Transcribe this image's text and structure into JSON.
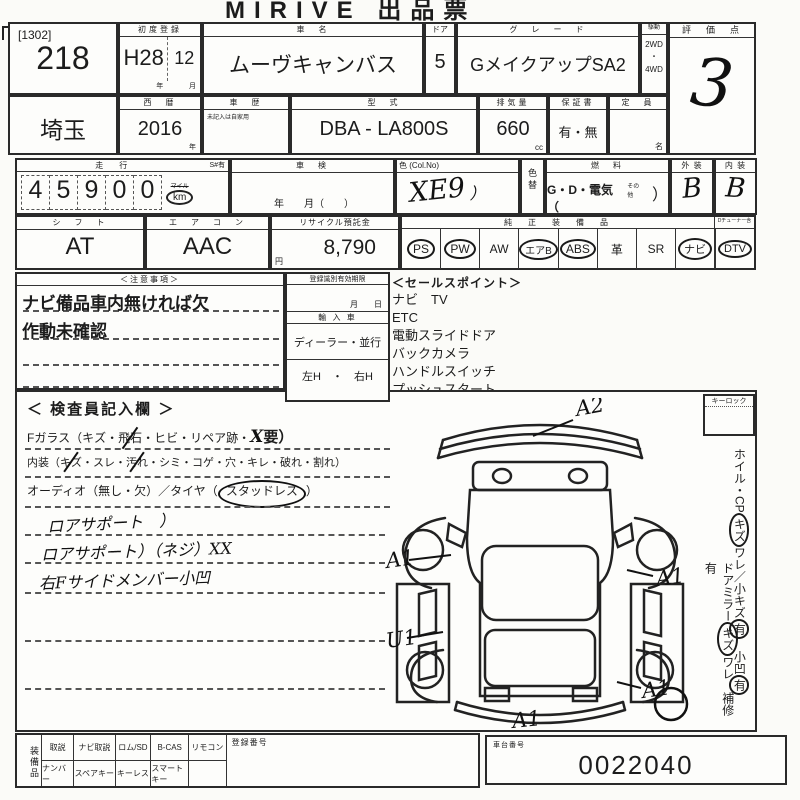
{
  "colors": {
    "ink": "#1c1c1c",
    "paper": "#fbfbf8"
  },
  "title": "MIRIVE 出品票",
  "lot": {
    "code": "[1302]",
    "number": "218"
  },
  "first_reg": {
    "label": "初度登録",
    "era": "H28",
    "month": "12",
    "year_unit": "年",
    "month_unit": "月"
  },
  "car": {
    "name_label": "車　名",
    "name": "ムーヴキャンバス",
    "door_label": "ドア",
    "door": "5",
    "grade_label": "グ　レ　ー　ド",
    "grade": "GメイクアップSA2",
    "drive_label": "駆動",
    "drive_2wd": "2WD",
    "drive_sep": "・",
    "drive_4wd": "4WD"
  },
  "score": {
    "label": "評　価　点",
    "value": "3"
  },
  "reg2": {
    "prefecture": "埼玉",
    "year_label": "西　暦",
    "year": "2016",
    "year_unit": "年",
    "history_label": "車　歴",
    "history_note": "未記入は自家用",
    "model_label": "型　式",
    "model": "DBA - LA800S",
    "disp_label": "排気量",
    "disp": "660",
    "disp_unit": "cc",
    "warranty_label": "保証書",
    "warranty": "有・無",
    "capacity_label": "定　員",
    "capacity_unit": "名"
  },
  "mileage": {
    "label": "走　行",
    "s_label": "S#有",
    "digits": [
      "4",
      "5",
      "9",
      "0",
      "0"
    ],
    "mile": "マイル",
    "km": "km"
  },
  "shaken": {
    "label": "車　検",
    "units": "年　　月（　　）"
  },
  "color": {
    "label": "色 (Col.No)",
    "value": "XE9",
    "paren": "）",
    "change_label": "色替"
  },
  "fuel": {
    "label": "燃　料",
    "value": "G・D・電気（",
    "other": "その他",
    "close": "）"
  },
  "panels": {
    "ext_label": "外 装",
    "ext": "B",
    "int_label": "内 装",
    "int": "B"
  },
  "row4": {
    "shift_label": "シ　フ　ト",
    "shift": "AT",
    "aircon_label": "エ　ア　コ　ン",
    "aircon": "AAC",
    "recycle_label": "リサイクル預託金",
    "recycle": "8,790",
    "recycle_unit": "円",
    "equip_label": "純　正　装　備　品",
    "dtv_note": "Dチューナー含",
    "equip_items": [
      {
        "text": "PS",
        "circled": true
      },
      {
        "text": "PW",
        "circled": true
      },
      {
        "text": "AW",
        "circled": false
      },
      {
        "text": "エアB",
        "circled": true
      },
      {
        "text": "ABS",
        "circled": true
      },
      {
        "text": "革",
        "circled": false
      },
      {
        "text": "SR",
        "circled": false
      },
      {
        "text": "ナビ",
        "circled": true
      },
      {
        "text": "DTV",
        "circled": true
      }
    ]
  },
  "notes": {
    "label": "＜注意事項＞",
    "line1": "ナビ備品車内無ければ欠",
    "line2": "作動未確認"
  },
  "regbox": {
    "label": "登録識別有効期限",
    "date_units": "月　　日",
    "import_label": "輸 入 車",
    "dealer_label": "ディーラー・並行",
    "handle_label": "左H　・　右H"
  },
  "sales": {
    "label": "＜セールスポイント＞",
    "items": [
      "ナビ　TV",
      "ETC",
      "電動スライドドア",
      "バックカメラ",
      "ハンドルスイッチ",
      "プッシュスタート"
    ]
  },
  "inspector": {
    "label": "＜ 検査員記入欄 ＞",
    "fglass": {
      "pre": "Fガラス（キズ・",
      "m1": "飛石",
      "mid": "・ヒビ・リペア跡・",
      "hand": "X",
      "tail": "要）"
    },
    "interior": {
      "pre": "内装（",
      "m1": "キズ",
      "mid1": "・スレ・",
      "m2": "汚れ",
      "tail": "・シミ・コゲ・穴・キレ・破れ・割れ）"
    },
    "audio": {
      "pre": "オーディオ（無し・欠）／タイヤ（",
      "m1": "スタッドレス",
      "tail": "）"
    },
    "hand_notes": [
      "ロアサポート　）",
      "ロアサポート）（ネジ）XX",
      "右Fサイドメンバー小凹"
    ]
  },
  "diagram": {
    "marks": {
      "a2": "A2",
      "a1_lf": "A1",
      "a1_rf": "A1",
      "u1": "U1",
      "a1_rr": "A1",
      "a1_btm": "A1"
    },
    "keylock": "キーロック"
  },
  "side_notes": {
    "col1_pre": "ホイル・CP",
    "col1_c1": "キズ",
    "col1_m1": "ワレ／小キズ",
    "col1_c2": "有",
    "col1_m2": "　小凹",
    "col1_c3": "有",
    "col2_pre": "ドアミラー",
    "col2_c1": "キズ",
    "col2_tail": "ワレ　補修有"
  },
  "bottom": {
    "equip_label": "装備品",
    "r1": [
      "取説",
      "ナビ取説",
      "ロム/SD",
      "B-CAS",
      "リモコン"
    ],
    "r2": [
      "ナンバー",
      "スペアキー",
      "キーレス",
      "スマートキー",
      ""
    ],
    "reg_no_label": "登録番号",
    "chassis_label": "車台番号",
    "chassis_no": "0022040"
  }
}
